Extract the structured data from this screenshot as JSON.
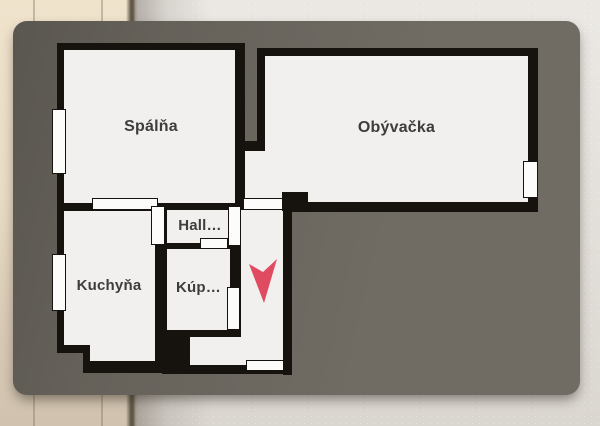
{
  "plan": {
    "rooms": [
      {
        "id": "spalna",
        "label": "Spálňa"
      },
      {
        "id": "obyvacka",
        "label": "Obývačka"
      },
      {
        "id": "kuchyna",
        "label": "Kuchyňa"
      },
      {
        "id": "hall",
        "label": "Hall…"
      },
      {
        "id": "kupelna",
        "label": "Kúp…"
      }
    ],
    "marker": {
      "icon": "location-arrow-icon",
      "color": "#e14b61"
    }
  },
  "colors": {
    "card_background": "#6b675f",
    "wall": "#16120e",
    "floor": "#f1f0ee",
    "opening": "#fcfcfa",
    "label_text": "#3d3d3d",
    "wall_left_beige": "#e9ddc5",
    "wall_right_plaster": "#e3dfd9"
  }
}
